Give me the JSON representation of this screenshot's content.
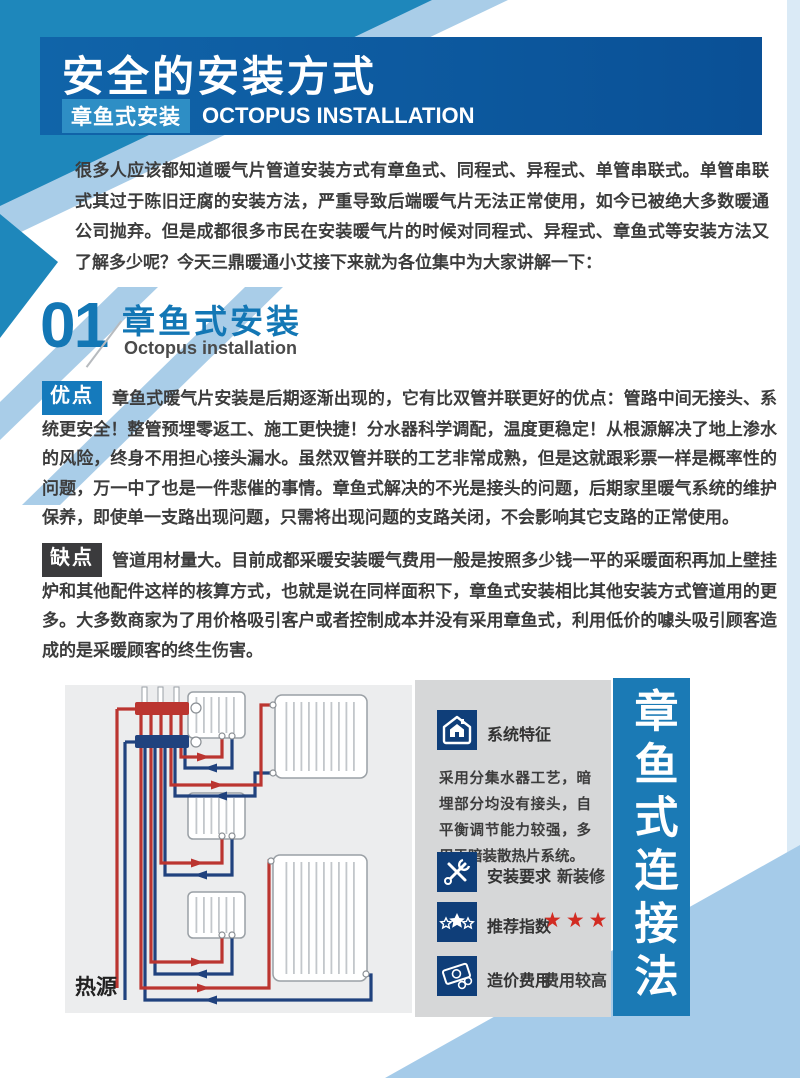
{
  "header": {
    "title": "安全的安装方式",
    "badge": "章鱼式安装",
    "subtitle_en": "OCTOPUS INSTALLATION"
  },
  "intro": "很多人应该都知道暖气片管道安装方式有章鱼式、同程式、异程式、单管串联式。单管串联式其过于陈旧迂腐的安装方法，严重导致后端暖气片无法正常使用，如今已被绝大多数暖通公司抛弃。但是成都很多市民在安装暖气片的时候对同程式、异程式、章鱼式等安装方法又了解多少呢？今天三鼎暖通小艾接下来就为各位集中为大家讲解一下：",
  "section": {
    "number": "01",
    "title": "章鱼式安装",
    "subtitle_en": "Octopus installation"
  },
  "pros": {
    "label": "优点",
    "text": "章鱼式暖气片安装是后期逐渐出现的，它有比双管并联更好的优点：管路中间无接头、系统更安全！整管预埋零返工、施工更快捷！分水器科学调配，温度更稳定！从根源解决了地上渗水的风险，终身不用担心接头漏水。虽然双管并联的工艺非常成熟，但是这就跟彩票一样是概率性的问题，万一中了也是一件悲催的事情。章鱼式解决的不光是接头的问题，后期家里暖气系统的维护保养，即使单一支路出现问题，只需将出现问题的支路关闭，不会影响其它支路的正常使用。"
  },
  "cons": {
    "label": "缺点",
    "text": "管道用材量大。目前成都采暖安装暖气费用一般是按照多少钱一平的采暖面积再加上壁挂炉和其他配件这样的核算方式，也就是说在同样面积下，章鱼式安装相比其他安装方式管道用的更多。大多数商家为了用价格吸引客户或者控制成本并没有采用章鱼式，利用低价的噱头吸引顾客造成的是采暖顾客的终生伤害。"
  },
  "diagram": {
    "heat_source_label": "热源"
  },
  "info_panel": {
    "features": {
      "icon": "house-icon",
      "label": "系统特征",
      "text": "采用分集水器工艺，暗埋部分均没有接头，自平衡调节能力较强，多用于暗装散热片系统。"
    },
    "install": {
      "icon": "tools-icon",
      "label": "安装要求",
      "value": "新装修"
    },
    "rating": {
      "icon": "stars-icon",
      "label": "推荐指数",
      "stars_count": 5,
      "stars_text": "★★★★★"
    },
    "cost": {
      "icon": "money-icon",
      "label": "造价费用",
      "value": "费用较高"
    }
  },
  "side_banner": "章鱼式连接法",
  "colors": {
    "header_blue": "#0f5fa5",
    "accent_blue": "#1377b5",
    "badge_light_blue": "#2e8ec5",
    "teal_band": "#1e87bb",
    "light_blue_band": "#a9cde8",
    "pros_badge": "#157abc",
    "cons_badge": "#3b3b3d",
    "panel_gray": "#d6d7d8",
    "diagram_gray": "#ecedee",
    "icon_navy": "#0f3e79",
    "star_red": "#d22b22",
    "pipe_red": "#bb3530",
    "pipe_blue": "#20427e",
    "side_bar_blue": "#1b7ab5"
  }
}
